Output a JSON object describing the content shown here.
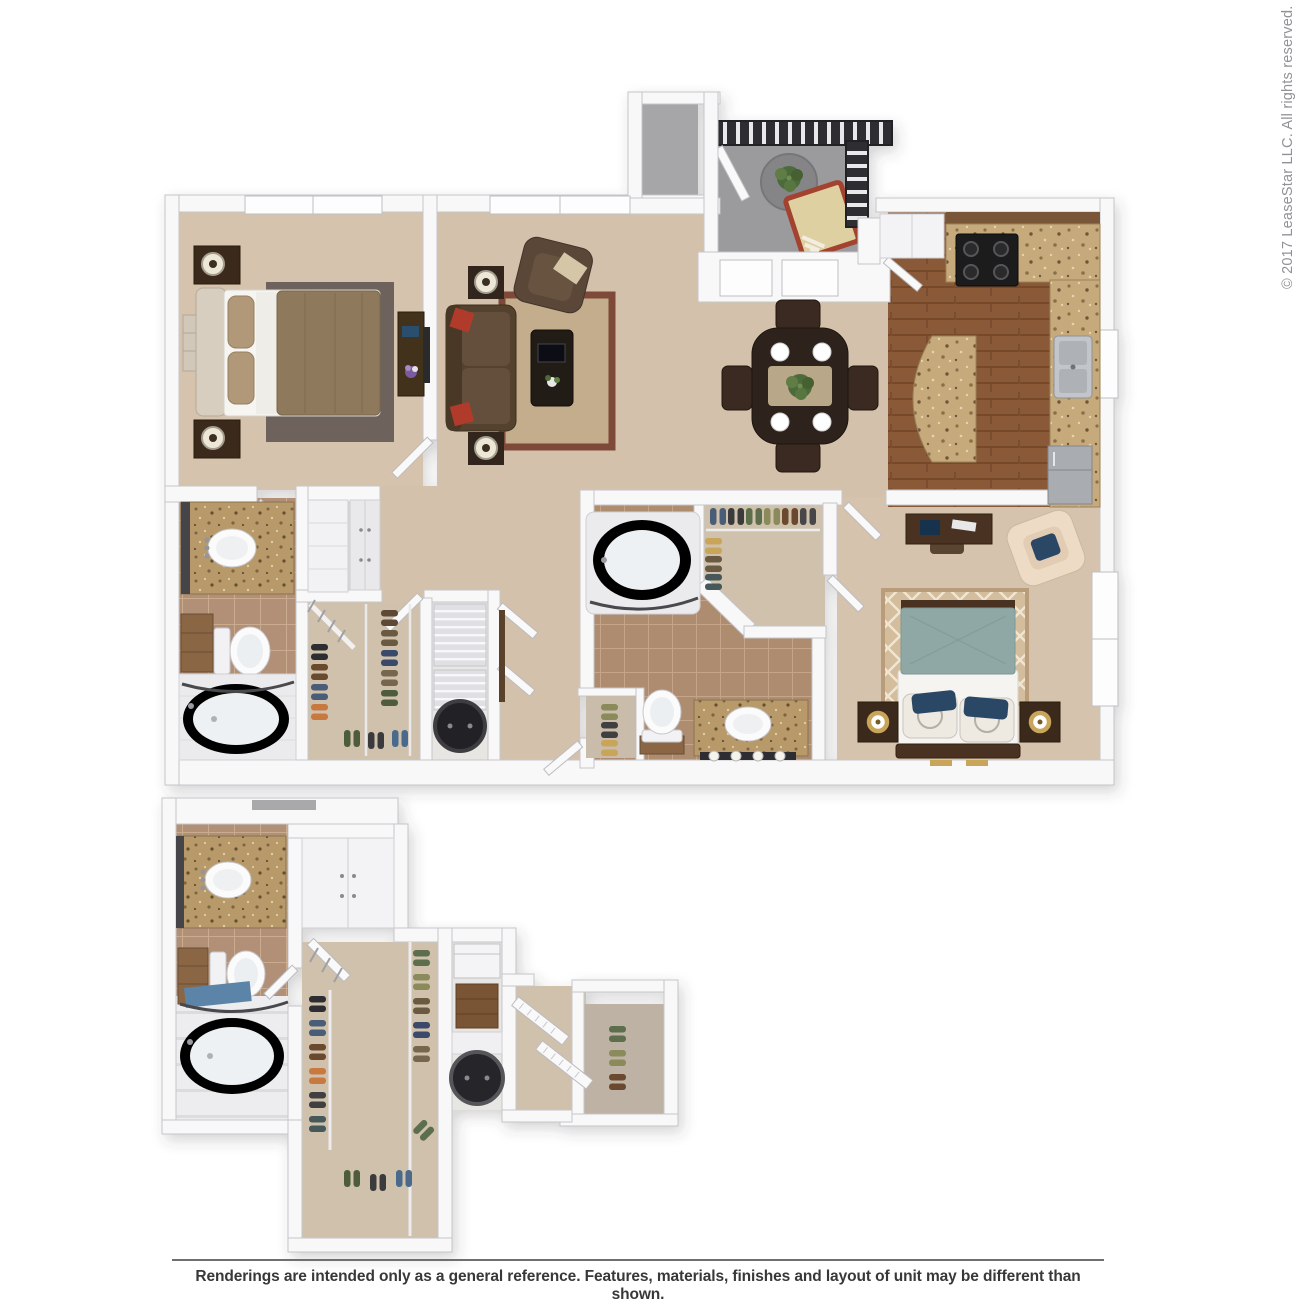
{
  "watermark": {
    "text": "© 2017 LeaseStar LLC. All rights reserved."
  },
  "footer": {
    "disclaimer": "Renderings are intended only as a general reference. Features, materials, finishes and layout of unit may be different than shown."
  },
  "floorplan": {
    "description": "3D top-down rendering of a two-bedroom, two-bathroom apartment with patio, living room, dining area, kitchen, walk-in closets and laundry, plus an enlarged detail view of the bathroom, walk-in closet and laundry area below.",
    "rooms": [
      "bedroom-1",
      "living-room",
      "dining-area",
      "kitchen",
      "patio",
      "storage-closet",
      "bathroom-1",
      "linen-closet",
      "walk-in-closet-1",
      "laundry-closet",
      "hallway",
      "bathroom-2",
      "walk-in-closet-2",
      "bedroom-2",
      "detail-bathroom",
      "detail-walk-in-closet",
      "detail-laundry",
      "detail-linen-closet",
      "detail-shoe-closet"
    ],
    "palette": {
      "background": "#ffffff",
      "wall": "#f8f8f9",
      "wall_edge": "#c6c6ca",
      "carpet": "#d4c1ab",
      "carpet_bedroom": "#d6c3ad",
      "carpet_closet": "#cfc1ab",
      "tile_bath1": "#b29077",
      "tile_bath2": "#ae8c70",
      "wood_floor": "#8a5a38",
      "granite": "#c6aa7c",
      "concrete_patio": "#9b9b9d",
      "railing": "#2e2e30",
      "sofa_brown": "#55422f",
      "accent_pillow_red": "#b03a2c",
      "bed1_duvet": "#8e795b",
      "bed2_teal": "#8fa7a5",
      "accent_pillow_navy": "#2c4766",
      "rug_living_center": "#c3ad8c",
      "rug_living_border": "#7e4a38",
      "rug_bedroom1": "#6d625b",
      "nightstand_wood": "#3b2a1c",
      "vanity_wood": "#8a6644",
      "watermark_gray": "#909295",
      "disclaimer_text": "#383838"
    }
  }
}
